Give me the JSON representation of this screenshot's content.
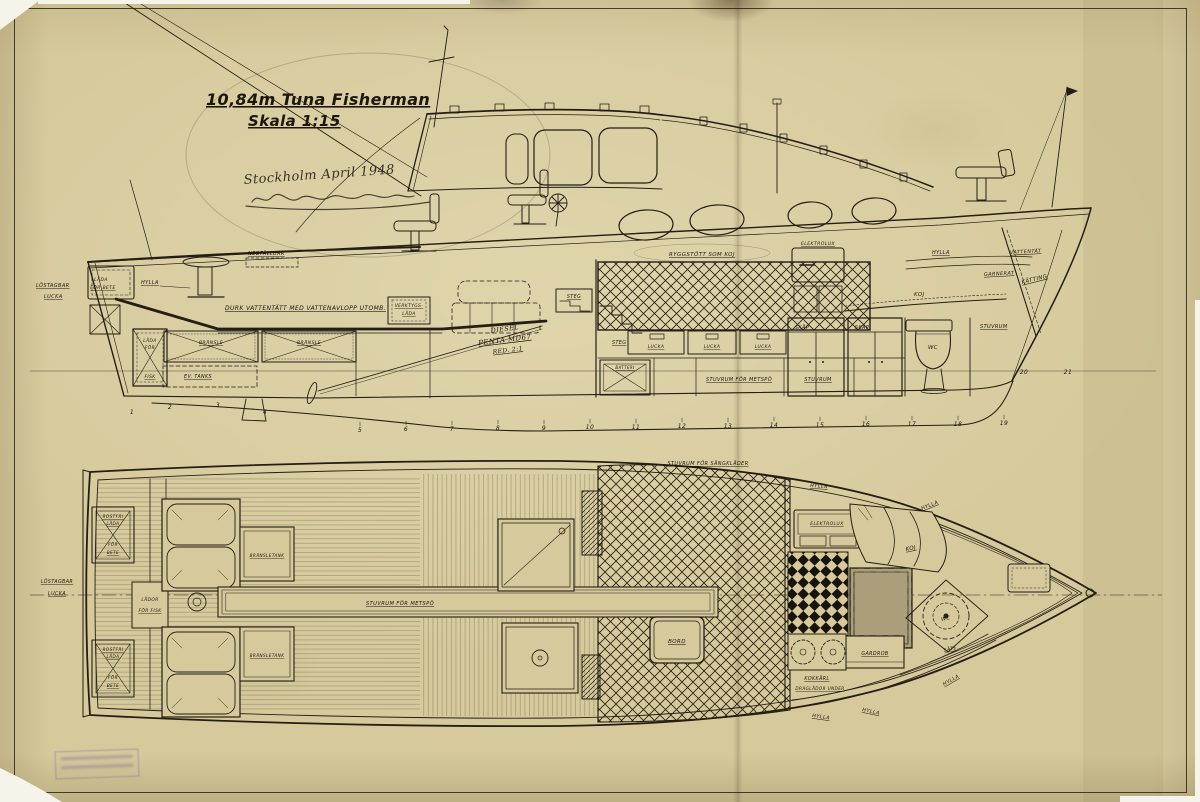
{
  "title": {
    "name": "10,84m Tuna Fisherman",
    "scale": "Skala 1:15",
    "note": "Stockholm April 1948"
  },
  "labels": {
    "lostagbar": "LÖSTAGBAR",
    "lucka": "LUCKA",
    "lada": "LÅDA",
    "for": "FÖR",
    "bete": "BETE",
    "for_bete": "FÖR BETE",
    "hylla": "HYLLA",
    "nedfallbar": "NEDFÄLLBAR",
    "durk": "DURK VATTENTÄTT MED VATTENAVLOPP UTOMB.",
    "bransle": "BRÄNSLE",
    "ev_tanks": "EV. TANKS",
    "fisk": "FISK",
    "verktygs": "VERKTYGS-",
    "diesel": "DIESEL",
    "penta": "PENTA MD67",
    "red": "RED. 2:1",
    "steg": "STEG",
    "ryggstott": "RYGGSTÖTT SOM KOJ",
    "batteri": "BATTERI",
    "stuvrum_metspo": "STUVRUM FÖR METSPÖ",
    "stuvrum": "STUVRUM",
    "skap": "SKÅP",
    "wc": "WC",
    "elektrolux": "ELEKTROLUX",
    "koj": "KOJ",
    "garnerat": "GARNERAT",
    "vattentat": "VATTENTÄT",
    "katting": "KÄTTING",
    "stuvrum_sangklader": "STUVRUM FÖR SÄNGKLÄDER",
    "rostfri": "ROSTFRI",
    "lador": "LÅDOR",
    "for_fisk": "FÖR FISK",
    "bransletank": "BRÄNSLETANK",
    "bord": "BORD",
    "kokkarl": "KOKKÄRL",
    "draglador": "DRAGLÅDOR UNDER",
    "gardrob": "GARDROB",
    "sate": "SÄTE"
  },
  "stations": [
    "1",
    "2",
    "3",
    "4",
    "5",
    "6",
    "7",
    "8",
    "9",
    "10",
    "11",
    "12",
    "13",
    "14",
    "15",
    "16",
    "17",
    "18",
    "19",
    "20",
    "21"
  ]
}
